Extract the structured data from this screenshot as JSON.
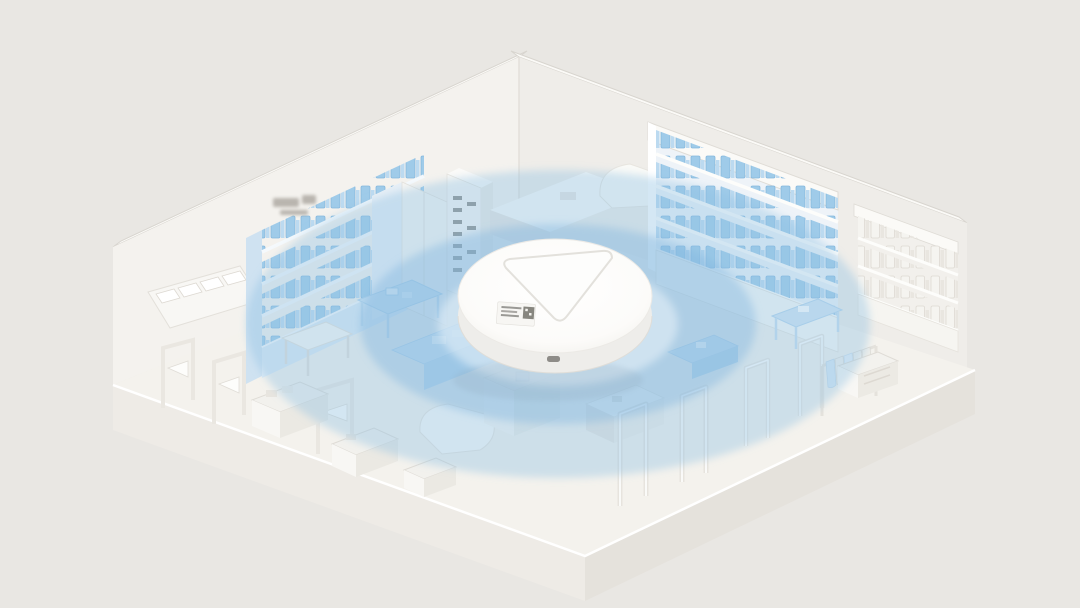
{
  "scene_name": "wifi-access-point-coverage-in-retail-store",
  "colors": {
    "background": "#e9e7e3",
    "wall": "#f4f2ee",
    "wall_right": "#efede9",
    "wall_cap": "#fbfaf7",
    "edge_line": "#d8d5cf",
    "floor": "#f4f2ed",
    "slab_left": "#eeebe6",
    "slab_right": "#e5e2dc",
    "furniture_white": "#fafaf7",
    "furniture_face": "#efede9",
    "furniture_side": "#e7e4df",
    "product_blue": "#9fcbe9",
    "product_blue_edge": "#85b8de",
    "product_white": "#f5f4f0",
    "blue_tint": "#cfe4f3",
    "blue_tint_deep": "#bcd8ec",
    "ring_outer": "#8fbfe3",
    "ring_mid": "#7fb5de",
    "ring_center": "#eaf2f9",
    "ap_white": "#fefefd",
    "ap_side": "#eeedea",
    "ap_line": "#e3e1dc",
    "shadow": "#d9d6d0",
    "slot_dark": "#72716d",
    "sign_grey": "#a9a49d"
  },
  "coverage": {
    "center_x": 558,
    "center_y": 324,
    "rings": [
      {
        "name": "outer-ring",
        "rx": 312,
        "ry": 154,
        "opacity": 0.38
      },
      {
        "name": "middle-ring",
        "rx": 198,
        "ry": 100,
        "opacity": 0.4
      },
      {
        "name": "inner-wash",
        "rx": 120,
        "ry": 62,
        "opacity": 0.55
      }
    ]
  },
  "access_point": {
    "center_x": 555,
    "center_y": 296,
    "radius_x": 97,
    "radius_y": 57,
    "parts": [
      "rounded-triangle-top",
      "qr-sticker",
      "port-notch"
    ]
  },
  "objects": [
    "left-wall",
    "right-wall",
    "floor-platform",
    "wall-shelf-left",
    "blurred-sign",
    "slat-rack",
    "tall-cabinet",
    "slot-tower",
    "back-counter",
    "kiosk-counter",
    "wall-shelf-back-right",
    "wall-shelf-right",
    "display-table",
    "checkout-counter",
    "gondola-shelf",
    "security-gate",
    "clothing-rack",
    "crate",
    "coverage-rings",
    "access-point"
  ]
}
